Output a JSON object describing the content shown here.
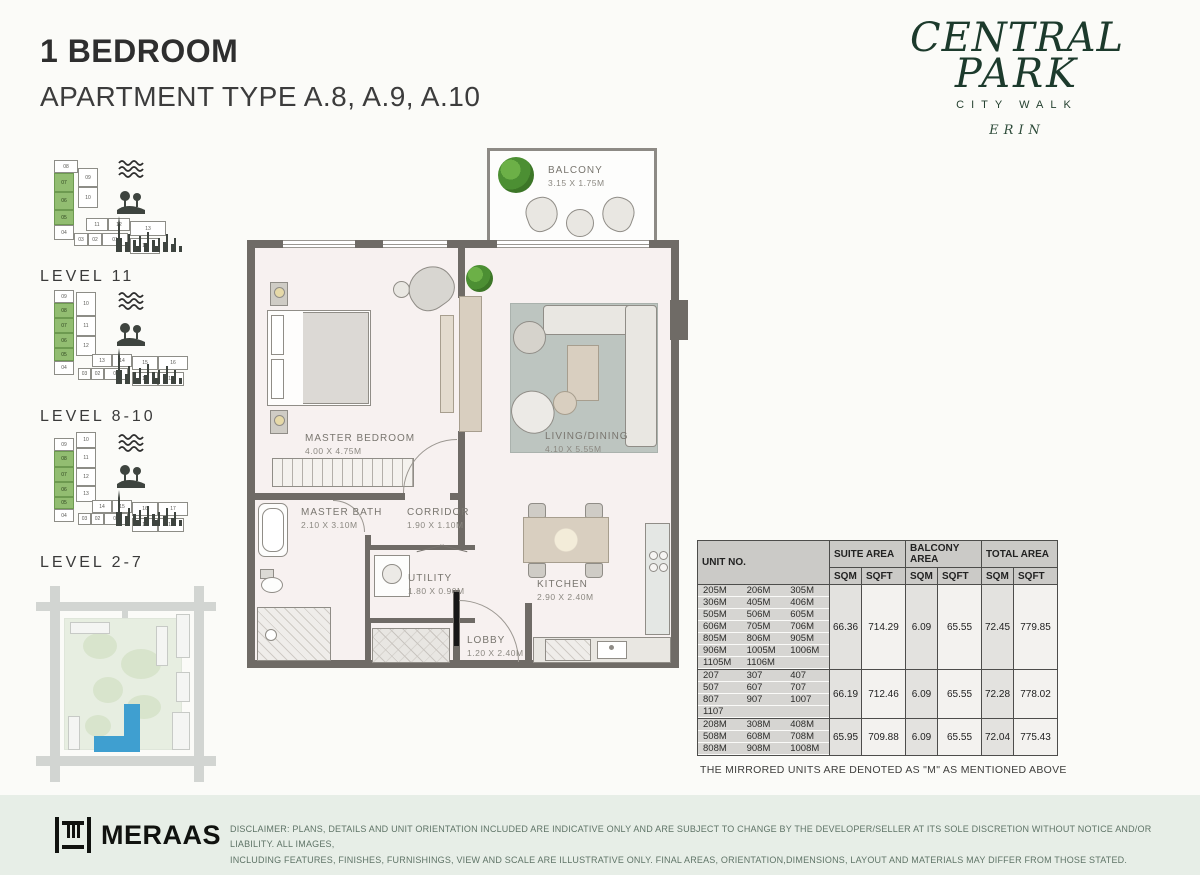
{
  "header": {
    "title": "1 BEDROOM",
    "subtitle": "APARTMENT TYPE A.8, A.9, A.10"
  },
  "brand": {
    "line1": "CENTRAL",
    "line2": "PARK",
    "line3": "CITY WALK",
    "line4": "ERIN",
    "color": "#1c3a2c"
  },
  "levels": [
    {
      "label": "LEVEL  11",
      "top": 158,
      "height": 128,
      "cells": [
        {
          "x": 14,
          "y": 2,
          "w": 24,
          "h": 13,
          "t": "08"
        },
        {
          "x": 38,
          "y": 10,
          "w": 20,
          "h": 19,
          "t": "09"
        },
        {
          "x": 14,
          "y": 15,
          "w": 20,
          "h": 19,
          "t": "07",
          "g": 1
        },
        {
          "x": 38,
          "y": 29,
          "w": 20,
          "h": 21,
          "t": "10"
        },
        {
          "x": 14,
          "y": 34,
          "w": 20,
          "h": 18,
          "t": "06",
          "g": 1
        },
        {
          "x": 14,
          "y": 52,
          "w": 20,
          "h": 15,
          "t": "05",
          "g": 1
        },
        {
          "x": 14,
          "y": 67,
          "w": 20,
          "h": 15,
          "t": "04"
        },
        {
          "x": 46,
          "y": 60,
          "w": 22,
          "h": 13,
          "t": "11"
        },
        {
          "x": 68,
          "y": 60,
          "w": 22,
          "h": 13,
          "t": "12"
        },
        {
          "x": 90,
          "y": 63,
          "w": 36,
          "h": 15,
          "t": "13"
        },
        {
          "x": 34,
          "y": 75,
          "w": 14,
          "h": 13,
          "t": "03"
        },
        {
          "x": 48,
          "y": 75,
          "w": 14,
          "h": 13,
          "t": "02"
        },
        {
          "x": 62,
          "y": 75,
          "w": 26,
          "h": 13,
          "t": "01"
        },
        {
          "x": 90,
          "y": 80,
          "w": 30,
          "h": 16,
          "t": "14"
        }
      ]
    },
    {
      "label": "LEVEL  8-10",
      "top": 290,
      "height": 136,
      "cells": [
        {
          "x": 14,
          "y": 0,
          "w": 20,
          "h": 13,
          "t": "09"
        },
        {
          "x": 36,
          "y": 2,
          "w": 20,
          "h": 24,
          "t": "10"
        },
        {
          "x": 14,
          "y": 13,
          "w": 20,
          "h": 15,
          "t": "08",
          "g": 1
        },
        {
          "x": 14,
          "y": 28,
          "w": 20,
          "h": 15,
          "t": "07",
          "g": 1
        },
        {
          "x": 36,
          "y": 26,
          "w": 20,
          "h": 20,
          "t": "11"
        },
        {
          "x": 14,
          "y": 43,
          "w": 20,
          "h": 15,
          "t": "06",
          "g": 1
        },
        {
          "x": 36,
          "y": 46,
          "w": 20,
          "h": 20,
          "t": "12"
        },
        {
          "x": 14,
          "y": 58,
          "w": 20,
          "h": 13,
          "t": "05",
          "g": 1
        },
        {
          "x": 14,
          "y": 71,
          "w": 20,
          "h": 14,
          "t": "04"
        },
        {
          "x": 52,
          "y": 64,
          "w": 20,
          "h": 13,
          "t": "13"
        },
        {
          "x": 72,
          "y": 64,
          "w": 20,
          "h": 13,
          "t": "14"
        },
        {
          "x": 92,
          "y": 66,
          "w": 26,
          "h": 14,
          "t": "15"
        },
        {
          "x": 118,
          "y": 66,
          "w": 30,
          "h": 14,
          "t": "16"
        },
        {
          "x": 38,
          "y": 78,
          "w": 13,
          "h": 12,
          "t": "03"
        },
        {
          "x": 51,
          "y": 78,
          "w": 13,
          "h": 12,
          "t": "02"
        },
        {
          "x": 64,
          "y": 78,
          "w": 24,
          "h": 12,
          "t": "01"
        },
        {
          "x": 92,
          "y": 82,
          "w": 26,
          "h": 14,
          "t": "18"
        },
        {
          "x": 118,
          "y": 82,
          "w": 26,
          "h": 14,
          "t": "17"
        }
      ]
    },
    {
      "label": "LEVEL  2-7",
      "top": 432,
      "height": 140,
      "cells": [
        {
          "x": 36,
          "y": 0,
          "w": 20,
          "h": 16,
          "t": "10"
        },
        {
          "x": 14,
          "y": 6,
          "w": 20,
          "h": 13,
          "t": "09"
        },
        {
          "x": 14,
          "y": 19,
          "w": 20,
          "h": 16,
          "t": "08",
          "g": 1
        },
        {
          "x": 36,
          "y": 16,
          "w": 20,
          "h": 20,
          "t": "11"
        },
        {
          "x": 14,
          "y": 35,
          "w": 20,
          "h": 15,
          "t": "07",
          "g": 1
        },
        {
          "x": 36,
          "y": 36,
          "w": 20,
          "h": 18,
          "t": "12"
        },
        {
          "x": 14,
          "y": 50,
          "w": 20,
          "h": 15,
          "t": "06",
          "g": 1
        },
        {
          "x": 36,
          "y": 54,
          "w": 20,
          "h": 16,
          "t": "13"
        },
        {
          "x": 14,
          "y": 65,
          "w": 20,
          "h": 12,
          "t": "05",
          "g": 1
        },
        {
          "x": 14,
          "y": 77,
          "w": 20,
          "h": 13,
          "t": "04"
        },
        {
          "x": 52,
          "y": 68,
          "w": 20,
          "h": 13,
          "t": "14"
        },
        {
          "x": 72,
          "y": 68,
          "w": 20,
          "h": 13,
          "t": "15"
        },
        {
          "x": 92,
          "y": 70,
          "w": 26,
          "h": 14,
          "t": "16"
        },
        {
          "x": 118,
          "y": 70,
          "w": 30,
          "h": 14,
          "t": "17"
        },
        {
          "x": 38,
          "y": 81,
          "w": 13,
          "h": 12,
          "t": "03"
        },
        {
          "x": 51,
          "y": 81,
          "w": 13,
          "h": 12,
          "t": "02"
        },
        {
          "x": 64,
          "y": 81,
          "w": 24,
          "h": 12,
          "t": "01"
        },
        {
          "x": 92,
          "y": 86,
          "w": 26,
          "h": 14,
          "t": "19"
        },
        {
          "x": 118,
          "y": 86,
          "w": 26,
          "h": 14,
          "t": "18"
        }
      ]
    }
  ],
  "floorplan": {
    "rooms": [
      {
        "name": "BALCONY",
        "dims": "3.15 X 1.75M"
      },
      {
        "name": "MASTER BEDROOM",
        "dims": "4.00 X 4.75M"
      },
      {
        "name": "LIVING/DINING",
        "dims": "4.10 X 5.55M"
      },
      {
        "name": "MASTER BATH",
        "dims": "2.10 X 3.10M"
      },
      {
        "name": "CORRIDOR",
        "dims": "1.90 X 1.10M"
      },
      {
        "name": "UTILITY",
        "dims": "1.80 X 0.90M"
      },
      {
        "name": "KITCHEN",
        "dims": "2.90 X 2.40M"
      },
      {
        "name": "LOBBY",
        "dims": "1.20 X 2.40M"
      }
    ]
  },
  "table": {
    "unit_header": "UNIT NO.",
    "col_groups": [
      "SUITE AREA",
      "BALCONY AREA",
      "TOTAL AREA"
    ],
    "sub_headers": [
      "SQM",
      "SQFT"
    ],
    "groups": [
      {
        "unit_rows": [
          [
            "205M",
            "206M",
            "305M"
          ],
          [
            "306M",
            "405M",
            "406M"
          ],
          [
            "505M",
            "506M",
            "605M"
          ],
          [
            "606M",
            "705M",
            "706M"
          ],
          [
            "805M",
            "806M",
            "905M"
          ],
          [
            "906M",
            "1005M",
            "1006M"
          ],
          [
            "1105M",
            "1106M",
            ""
          ]
        ],
        "values": [
          "66.36",
          "714.29",
          "6.09",
          "65.55",
          "72.45",
          "779.85"
        ]
      },
      {
        "unit_rows": [
          [
            "207",
            "307",
            "407"
          ],
          [
            "507",
            "607",
            "707"
          ],
          [
            "807",
            "907",
            "1007"
          ],
          [
            "1107",
            "",
            ""
          ]
        ],
        "values": [
          "66.19",
          "712.46",
          "6.09",
          "65.55",
          "72.28",
          "778.02"
        ]
      },
      {
        "unit_rows": [
          [
            "208M",
            "308M",
            "408M"
          ],
          [
            "508M",
            "608M",
            "708M"
          ],
          [
            "808M",
            "908M",
            "1008M"
          ]
        ],
        "values": [
          "65.95",
          "709.88",
          "6.09",
          "65.55",
          "72.04",
          "775.43"
        ]
      }
    ],
    "note": "THE MIRRORED UNITS ARE DENOTED AS \"M\" AS MENTIONED ABOVE"
  },
  "footer": {
    "logo_text": "MERAAS",
    "disclaimer_line1": "DISCLAIMER: PLANS, DETAILS AND UNIT ORIENTATION INCLUDED ARE INDICATIVE ONLY AND ARE SUBJECT TO CHANGE BY THE DEVELOPER/SELLER AT ITS SOLE DISCRETION WITHOUT NOTICE AND/OR LIABILITY. ALL IMAGES,",
    "disclaimer_line2": "INCLUDING FEATURES, FINISHES, FURNISHINGS, VIEW AND SCALE ARE ILLUSTRATIVE ONLY. FINAL AREAS, ORIENTATION,DIMENSIONS, LAYOUT AND MATERIALS MAY DIFFER FROM THOSE STATED."
  }
}
